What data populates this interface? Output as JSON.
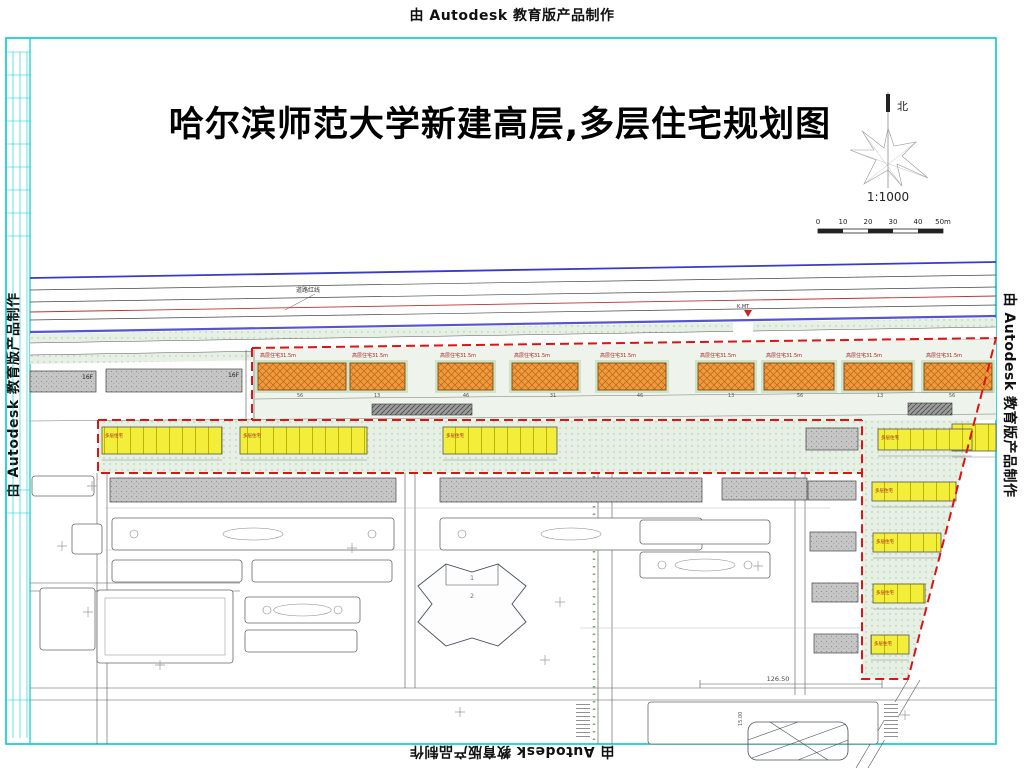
{
  "watermark": {
    "text": "由 Autodesk 教育版产品制作"
  },
  "title": {
    "text": "哈尔滨师范大学新建高层,多层住宅规划图"
  },
  "north": {
    "label": "北"
  },
  "scale": {
    "ratio": "1:1000",
    "ticks": [
      "0",
      "10",
      "20",
      "30",
      "40",
      "50m"
    ]
  },
  "annotations": {
    "road_red_line": "道路红线",
    "k_marker": "K.MT",
    "dim_main": "126.50",
    "dim_side": "15.00",
    "cross_room_1": "1",
    "cross_room_2": "2"
  },
  "site": {
    "highrise_label": "高层住宅31.5m",
    "midrise_label": "多层住宅",
    "floor_label": "16F",
    "highrise_row": [
      [
        258,
        363,
        88,
        27
      ],
      [
        350,
        363,
        55,
        27
      ],
      [
        438,
        363,
        55,
        27
      ],
      [
        512,
        363,
        66,
        27
      ],
      [
        598,
        363,
        68,
        27
      ],
      [
        698,
        363,
        56,
        27
      ],
      [
        764,
        363,
        70,
        27
      ],
      [
        844,
        363,
        68,
        27
      ],
      [
        924,
        363,
        68,
        27
      ]
    ],
    "yellow_row": [
      [
        102,
        427,
        120,
        27,
        1
      ],
      [
        240,
        427,
        127,
        27,
        1
      ],
      [
        443,
        427,
        114,
        27,
        1
      ],
      [
        952,
        424,
        44,
        27,
        0
      ]
    ],
    "yellow_wedge": [
      [
        878,
        429,
        94,
        21,
        1
      ],
      [
        872,
        482,
        84,
        19,
        1
      ],
      [
        873,
        533,
        68,
        19,
        1
      ],
      [
        873,
        584,
        52,
        19,
        1
      ],
      [
        871,
        635,
        38,
        19,
        1
      ]
    ],
    "gray_slabs": [
      [
        30,
        371,
        66,
        21,
        "16F"
      ],
      [
        106,
        369,
        136,
        23,
        "16F"
      ],
      [
        110,
        478,
        286,
        24,
        ""
      ],
      [
        440,
        478,
        262,
        24,
        ""
      ],
      [
        722,
        478,
        85,
        22,
        ""
      ],
      [
        806,
        428,
        52,
        22,
        ""
      ],
      [
        808,
        481,
        48,
        19,
        ""
      ],
      [
        810,
        532,
        46,
        19,
        ""
      ],
      [
        812,
        583,
        46,
        19,
        ""
      ],
      [
        814,
        634,
        44,
        19,
        ""
      ]
    ],
    "dark_strips": [
      [
        372,
        404,
        100,
        11
      ],
      [
        908,
        403,
        44,
        12
      ]
    ],
    "outline_blocks": [
      [
        112,
        518,
        282,
        32,
        "ellipses"
      ],
      [
        440,
        518,
        262,
        32,
        "ellipses"
      ],
      [
        112,
        560,
        130,
        22,
        "plain"
      ],
      [
        252,
        560,
        140,
        22,
        "plain"
      ],
      [
        97,
        590,
        136,
        73,
        "big"
      ],
      [
        245,
        597,
        115,
        26,
        "ellipses"
      ],
      [
        245,
        630,
        112,
        22,
        "plain"
      ],
      [
        40,
        588,
        55,
        62,
        "plain"
      ],
      [
        72,
        524,
        30,
        30,
        "plain"
      ],
      [
        32,
        476,
        62,
        20,
        "plain"
      ],
      [
        640,
        520,
        130,
        24,
        "plain"
      ],
      [
        640,
        552,
        130,
        26,
        "ellipses"
      ],
      [
        648,
        702,
        230,
        42,
        "plain"
      ]
    ],
    "dims_row": [
      [
        300,
        "56"
      ],
      [
        377,
        "13"
      ],
      [
        466,
        "46"
      ],
      [
        553,
        "31"
      ],
      [
        640,
        "46"
      ],
      [
        731,
        "13"
      ],
      [
        800,
        "56"
      ],
      [
        880,
        "13"
      ],
      [
        952,
        "56"
      ]
    ],
    "crosses": [
      [
        62,
        546
      ],
      [
        88,
        612
      ],
      [
        352,
        548
      ],
      [
        560,
        602
      ],
      [
        758,
        566
      ],
      [
        92,
        486
      ],
      [
        905,
        715
      ],
      [
        460,
        712
      ],
      [
        545,
        660
      ],
      [
        160,
        665
      ]
    ]
  },
  "colors": {
    "frame": "#00cccc",
    "boundary": "#dd1414",
    "highrise": "#f0993f",
    "midrise": "#f2ee39",
    "road_blue": "#3a3ac8",
    "green": "#e6f0e4"
  }
}
